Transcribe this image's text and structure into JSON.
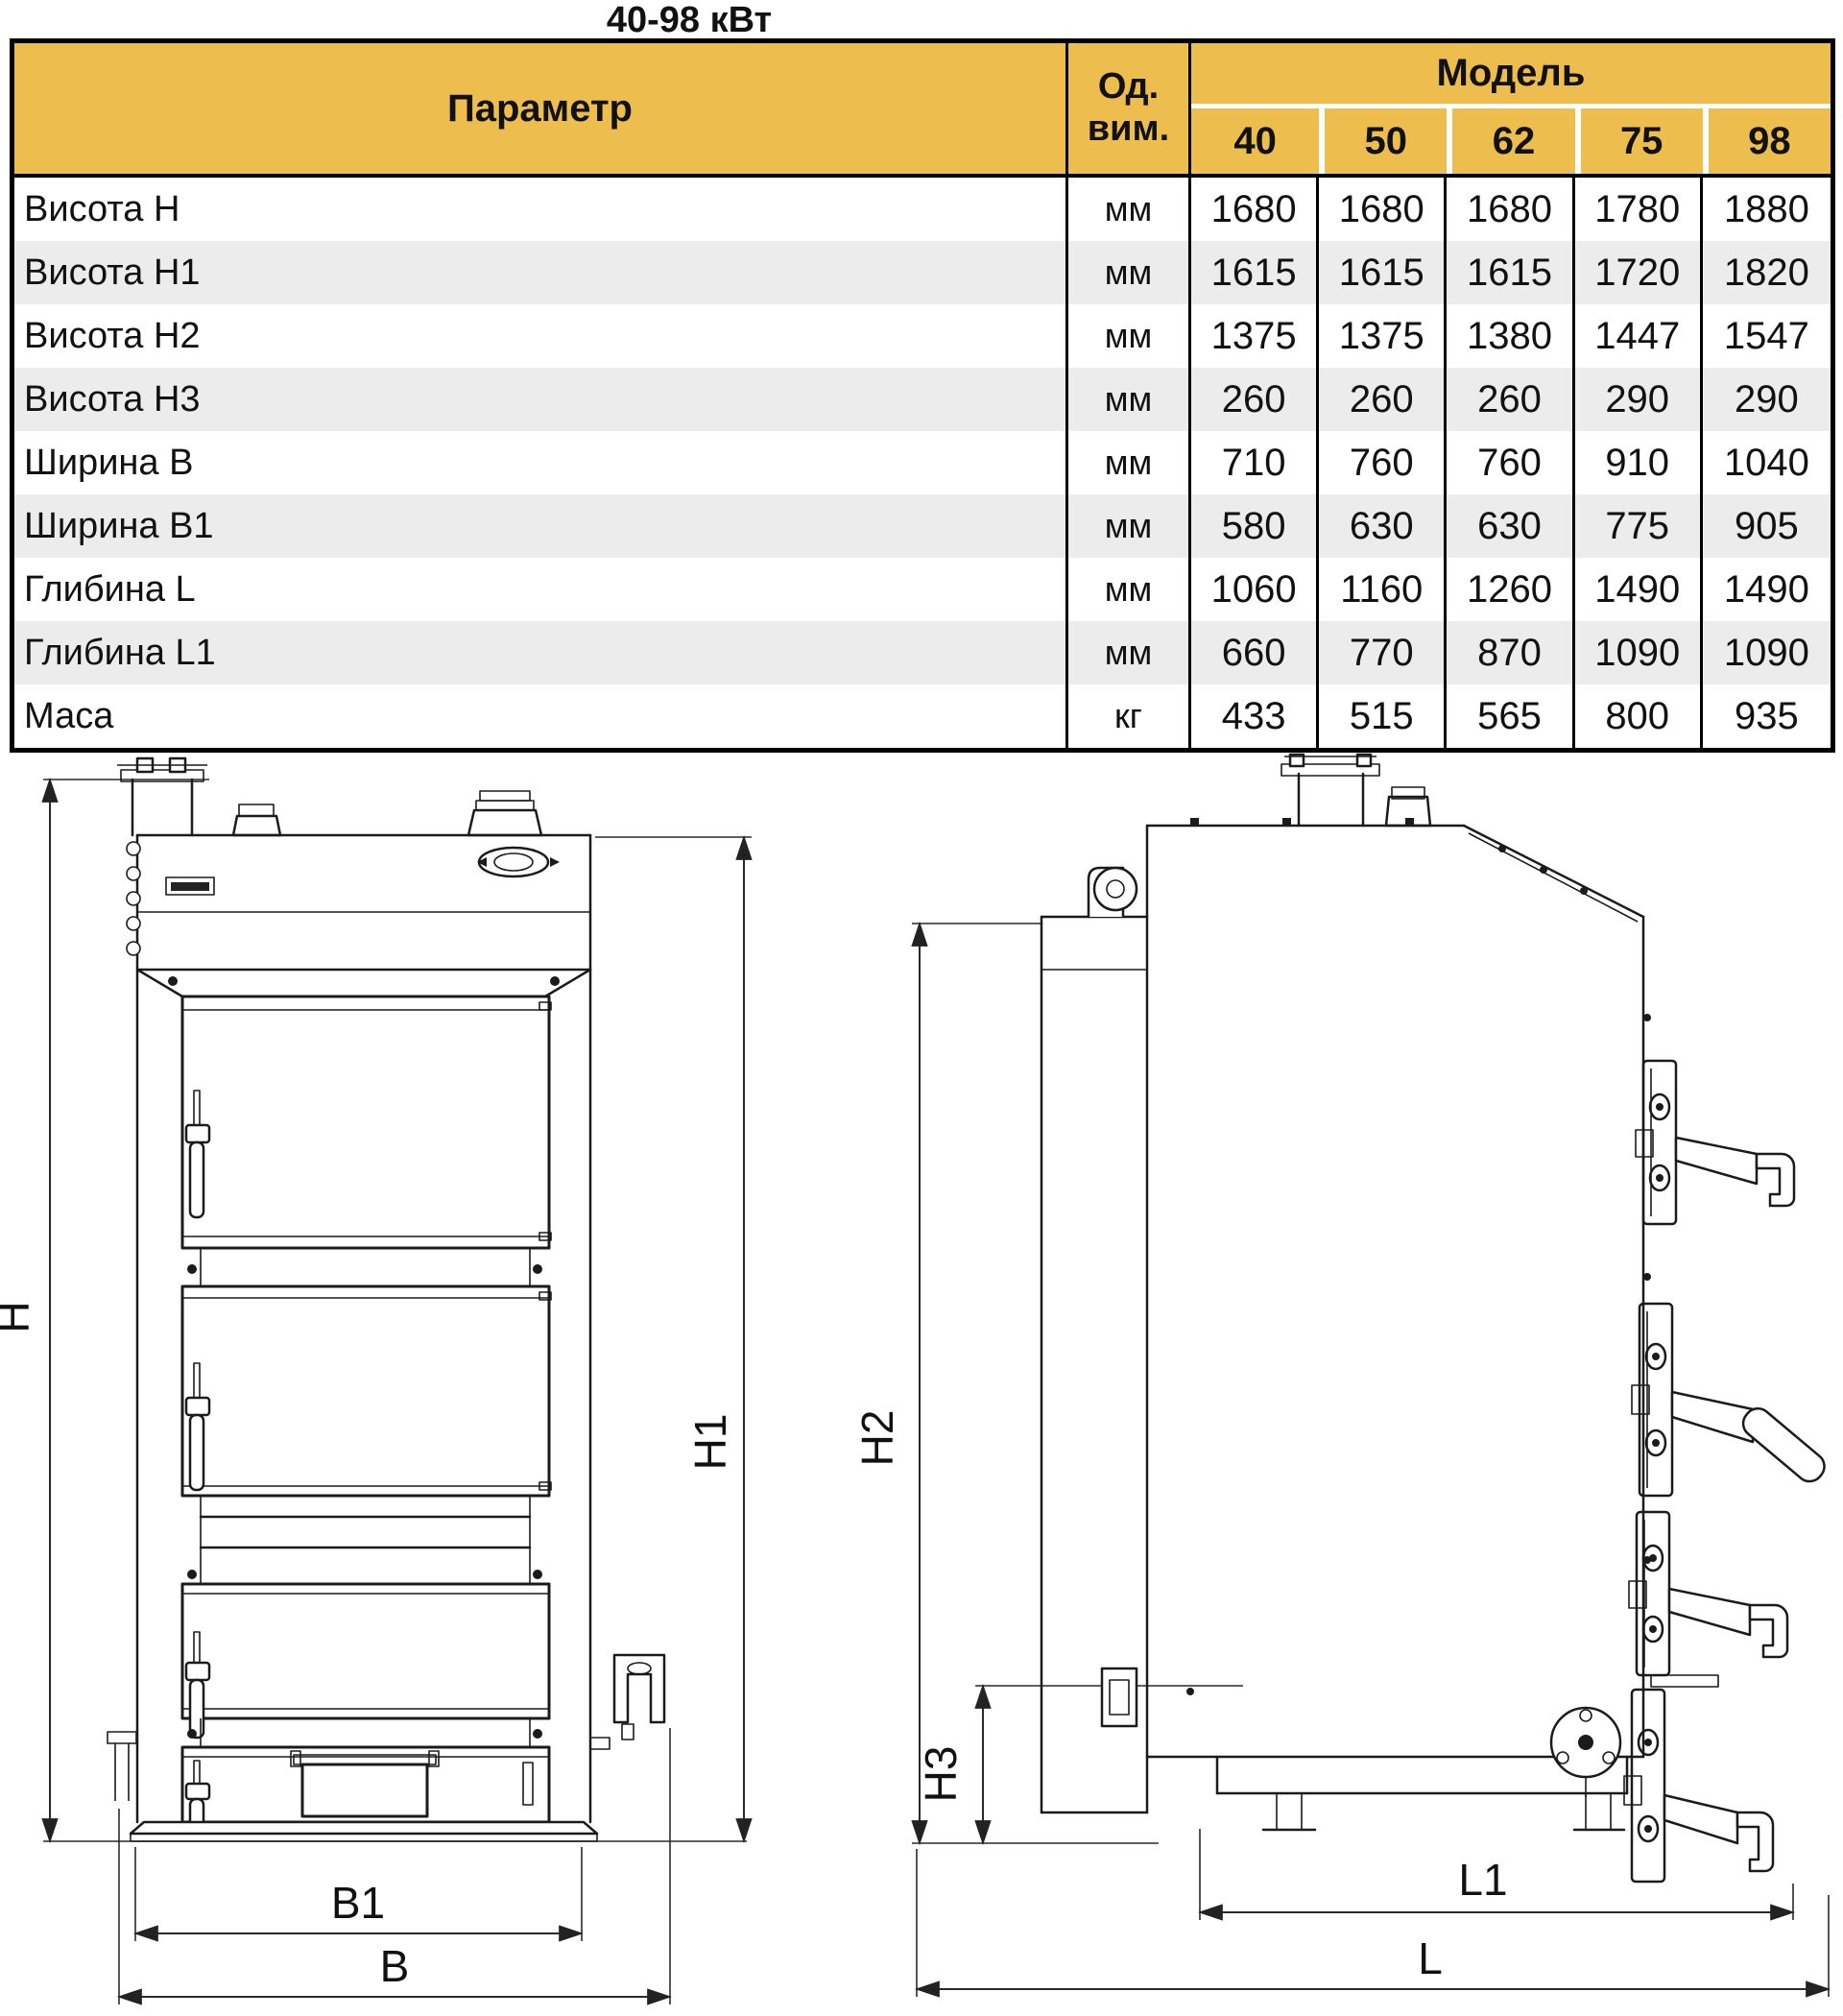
{
  "title": "40-98 кВт",
  "table": {
    "header": {
      "parameter": "Параметр",
      "unit_label": "Од. вим.",
      "model_label": "Модель",
      "models": [
        "40",
        "50",
        "62",
        "75",
        "98"
      ]
    },
    "rows": [
      {
        "label": "Висота H",
        "unit": "мм",
        "values": [
          "1680",
          "1680",
          "1680",
          "1780",
          "1880"
        ]
      },
      {
        "label": "Висота H1",
        "unit": "мм",
        "values": [
          "1615",
          "1615",
          "1615",
          "1720",
          "1820"
        ]
      },
      {
        "label": "Висота H2",
        "unit": "мм",
        "values": [
          "1375",
          "1375",
          "1380",
          "1447",
          "1547"
        ]
      },
      {
        "label": "Висота H3",
        "unit": "мм",
        "values": [
          "260",
          "260",
          "260",
          "290",
          "290"
        ]
      },
      {
        "label": "Ширина B",
        "unit": "мм",
        "values": [
          "710",
          "760",
          "760",
          "910",
          "1040"
        ]
      },
      {
        "label": "Ширина B1",
        "unit": "мм",
        "values": [
          "580",
          "630",
          "630",
          "775",
          "905"
        ]
      },
      {
        "label": "Глибина L",
        "unit": "мм",
        "values": [
          "1060",
          "1160",
          "1260",
          "1490",
          "1490"
        ]
      },
      {
        "label": "Глибина L1",
        "unit": "мм",
        "values": [
          "660",
          "770",
          "870",
          "1090",
          "1090"
        ]
      },
      {
        "label": "Маса",
        "unit": "кг",
        "values": [
          "433",
          "515",
          "565",
          "800",
          "935"
        ]
      }
    ]
  },
  "drawings": {
    "front": {
      "h": "H",
      "h1": "H1",
      "b1": "B1",
      "b": "B"
    },
    "side": {
      "h2": "H2",
      "h3": "H3",
      "l1": "L1",
      "l": "L"
    }
  },
  "colors": {
    "header_bg": "#edbe4d",
    "row_alt_bg": "#ececec",
    "table_border": "#000000",
    "line": "#1b1b1b"
  }
}
